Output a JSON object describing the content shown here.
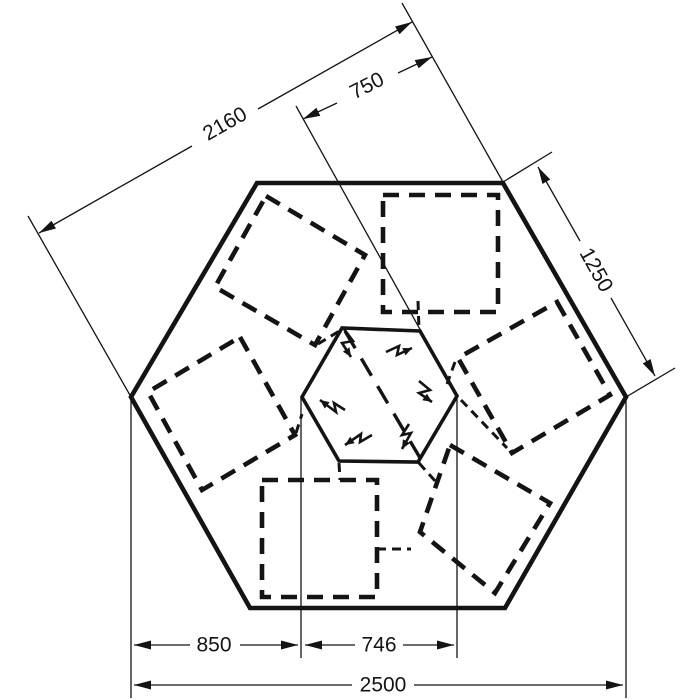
{
  "diagram": {
    "background_color": "#ffffff",
    "line_color": "#141414",
    "dimensions": {
      "across_flats": "2160",
      "top_offset": "750",
      "side_edge": "1250",
      "bottom_left_segment": "850",
      "bottom_center_segment": "746",
      "overall_width": "2500"
    },
    "symbols": {
      "lightning_bolt_count": 6,
      "panel_square_count": 6
    }
  }
}
